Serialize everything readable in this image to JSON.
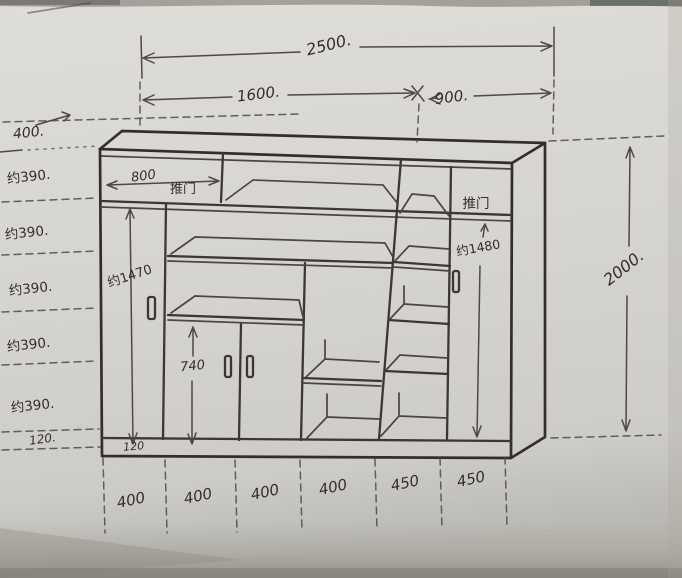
{
  "dims": {
    "width_total": "2500.",
    "width_left": "1600.",
    "width_right": "900.",
    "height_total": "2000."
  },
  "left_rows": [
    "400.",
    "约390.",
    "约390.",
    "约390.",
    "约390.",
    "约390.",
    "120."
  ],
  "bottom_cols": [
    "400",
    "400",
    "400",
    "400",
    "450",
    "450"
  ],
  "labels": {
    "top_left_width": "800",
    "sliding_door_left": "推门",
    "sliding_door_right": "推门",
    "left_door_height": "约1470",
    "right_door_height": "约1480",
    "lower_door_height": "740",
    "plinth_height": "120"
  }
}
